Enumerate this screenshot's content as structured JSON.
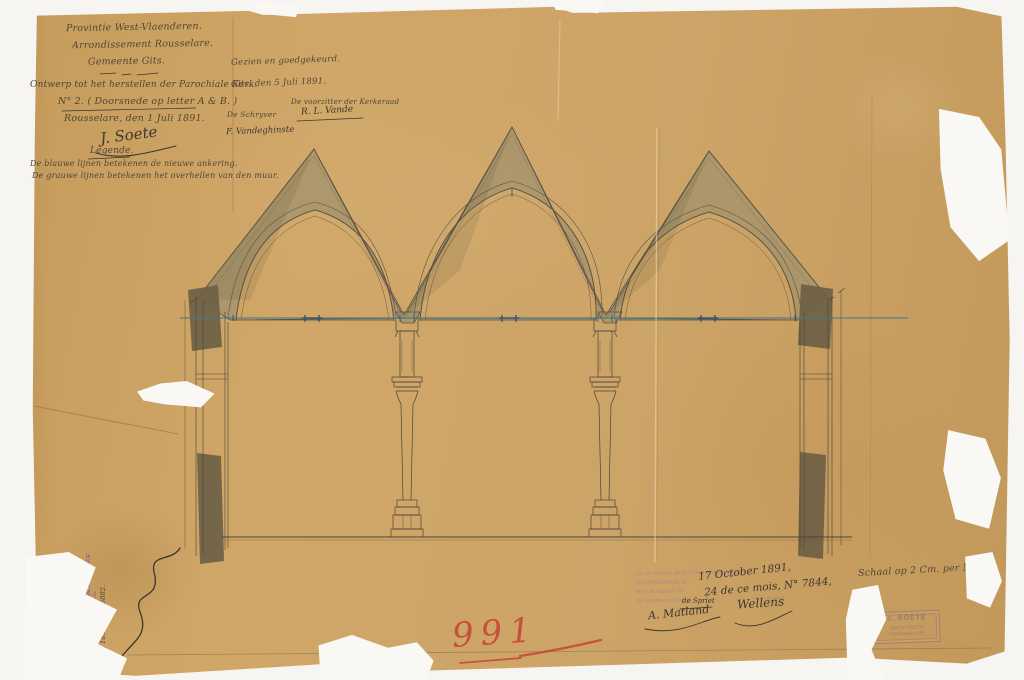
{
  "title_block": {
    "province": "Provintie West-Vlaenderen.",
    "arrondissement": "Arrondissement Rousselare.",
    "gemeente": "Gemeente Gits.",
    "project": "Ontwerp tot het herstellen der Parochiale Kerk.",
    "sheet": "N° 2. ( Doorsnede op letter A & B. )",
    "place_date": "Rousselare, den 1 Juli 1891.",
    "architect_signature": "J. Soete"
  },
  "approval": {
    "seen": "Gezien en goedgekeurd.",
    "place_date": "Gits, den 5 Juli 1891.",
    "chairman_title": "De voorzitter der Kerkeraad",
    "chairman_signature": "R. L. Vande",
    "secretary_title": "De Schryver",
    "secretary_signature": "F. Vandeghinste"
  },
  "legend": {
    "heading": "Legende.",
    "blue_line": "De blauwe lijnen betekenen de nieuwe ankering.",
    "grey_line": "De grauwe lijnen betekenen het overhellen van den muur."
  },
  "commission_block": {
    "stamp_line1": "Vu en séance de la Commission Royale",
    "stamp_line2": "des Monuments, le",
    "stamp_line3": "sous le rapport N°",
    "stamp_footer_left": "Le Secrétaire Général,",
    "stamp_footer_right": "Le Président,",
    "note_line1": "17 October 1891,",
    "note_line2": "24 de ce mois, N° 7844,",
    "small_note": "de Spriet",
    "signature_left": "A. Matland",
    "signature_right": "Wellens"
  },
  "scale_note": "Schaal op 2 Cm. per M.",
  "inventory_number": "991",
  "architect_stamp": {
    "line1": "J. SOETE",
    "line2": "ARCHITECTE",
    "line3": "ROUSSELARE"
  },
  "ministry_stamp": {
    "line1": "VU PAR NOUS MINISTRE DE LA JUSTICE",
    "line2": "Pour être annexé à l'arrêté royal du",
    "line3": "9 Nov. 1891 — N° 6882."
  },
  "drawing": {
    "subject": "Doorsnede: drie puntgevels met spitsbogen op zuilen (kerk Gits)",
    "colors": {
      "paper": "#cda467",
      "ink": "#4a443a",
      "wash": "#a3926b",
      "dark_wall": "#6e6046",
      "blue_anchor_line": "#46788a",
      "red_number": "#c8503e",
      "stamp_purple": "#8a5f9e"
    }
  }
}
